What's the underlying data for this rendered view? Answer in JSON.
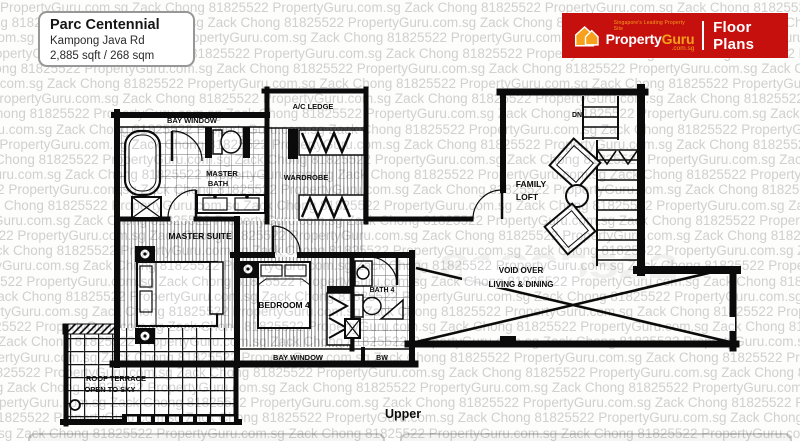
{
  "header": {
    "project": "Parc Centennial",
    "address": "Kampong Java Rd",
    "area": "2,885 sqft / 268 sqm"
  },
  "brand": {
    "tagline": "Singapore's Leading Property Site",
    "name_a": "Property",
    "name_b": "Guru",
    "suffix": ".com.sg",
    "section": "Floor Plans"
  },
  "colors": {
    "brand_red": "#c5100e",
    "brand_orange": "#f6a01c",
    "watermark_gray": "#d2d2d2",
    "wall_black": "#0b0b0b"
  },
  "watermark": {
    "phrase": "PropertyGuru.com.sg Zack Chong 81825522",
    "ghost_text": "Zack Chong 81825522"
  },
  "plan": {
    "level": "Upper",
    "labels": {
      "bay_window_top": "BAY WINDOW",
      "ac_ledge": "A/C LEDGE",
      "master_bath_line1": "MASTER",
      "master_bath_line2": "BATH",
      "wardrobe": "WARDROBE",
      "master_suite": "MASTER SUITE",
      "bedroom4": "BEDROOM 4",
      "bath4": "BATH 4",
      "family_loft_line1": "FAMILY",
      "family_loft_line2": "LOFT",
      "dn": "DN",
      "void_line1": "VOID OVER",
      "void_line2": "LIVING & DINING",
      "bay_window_bottom": "BAY WINDOW",
      "bw": "BW",
      "roof_terrace_line1": "ROOF TERRACE",
      "roof_terrace_line2": "OPEN TO SKY"
    }
  }
}
